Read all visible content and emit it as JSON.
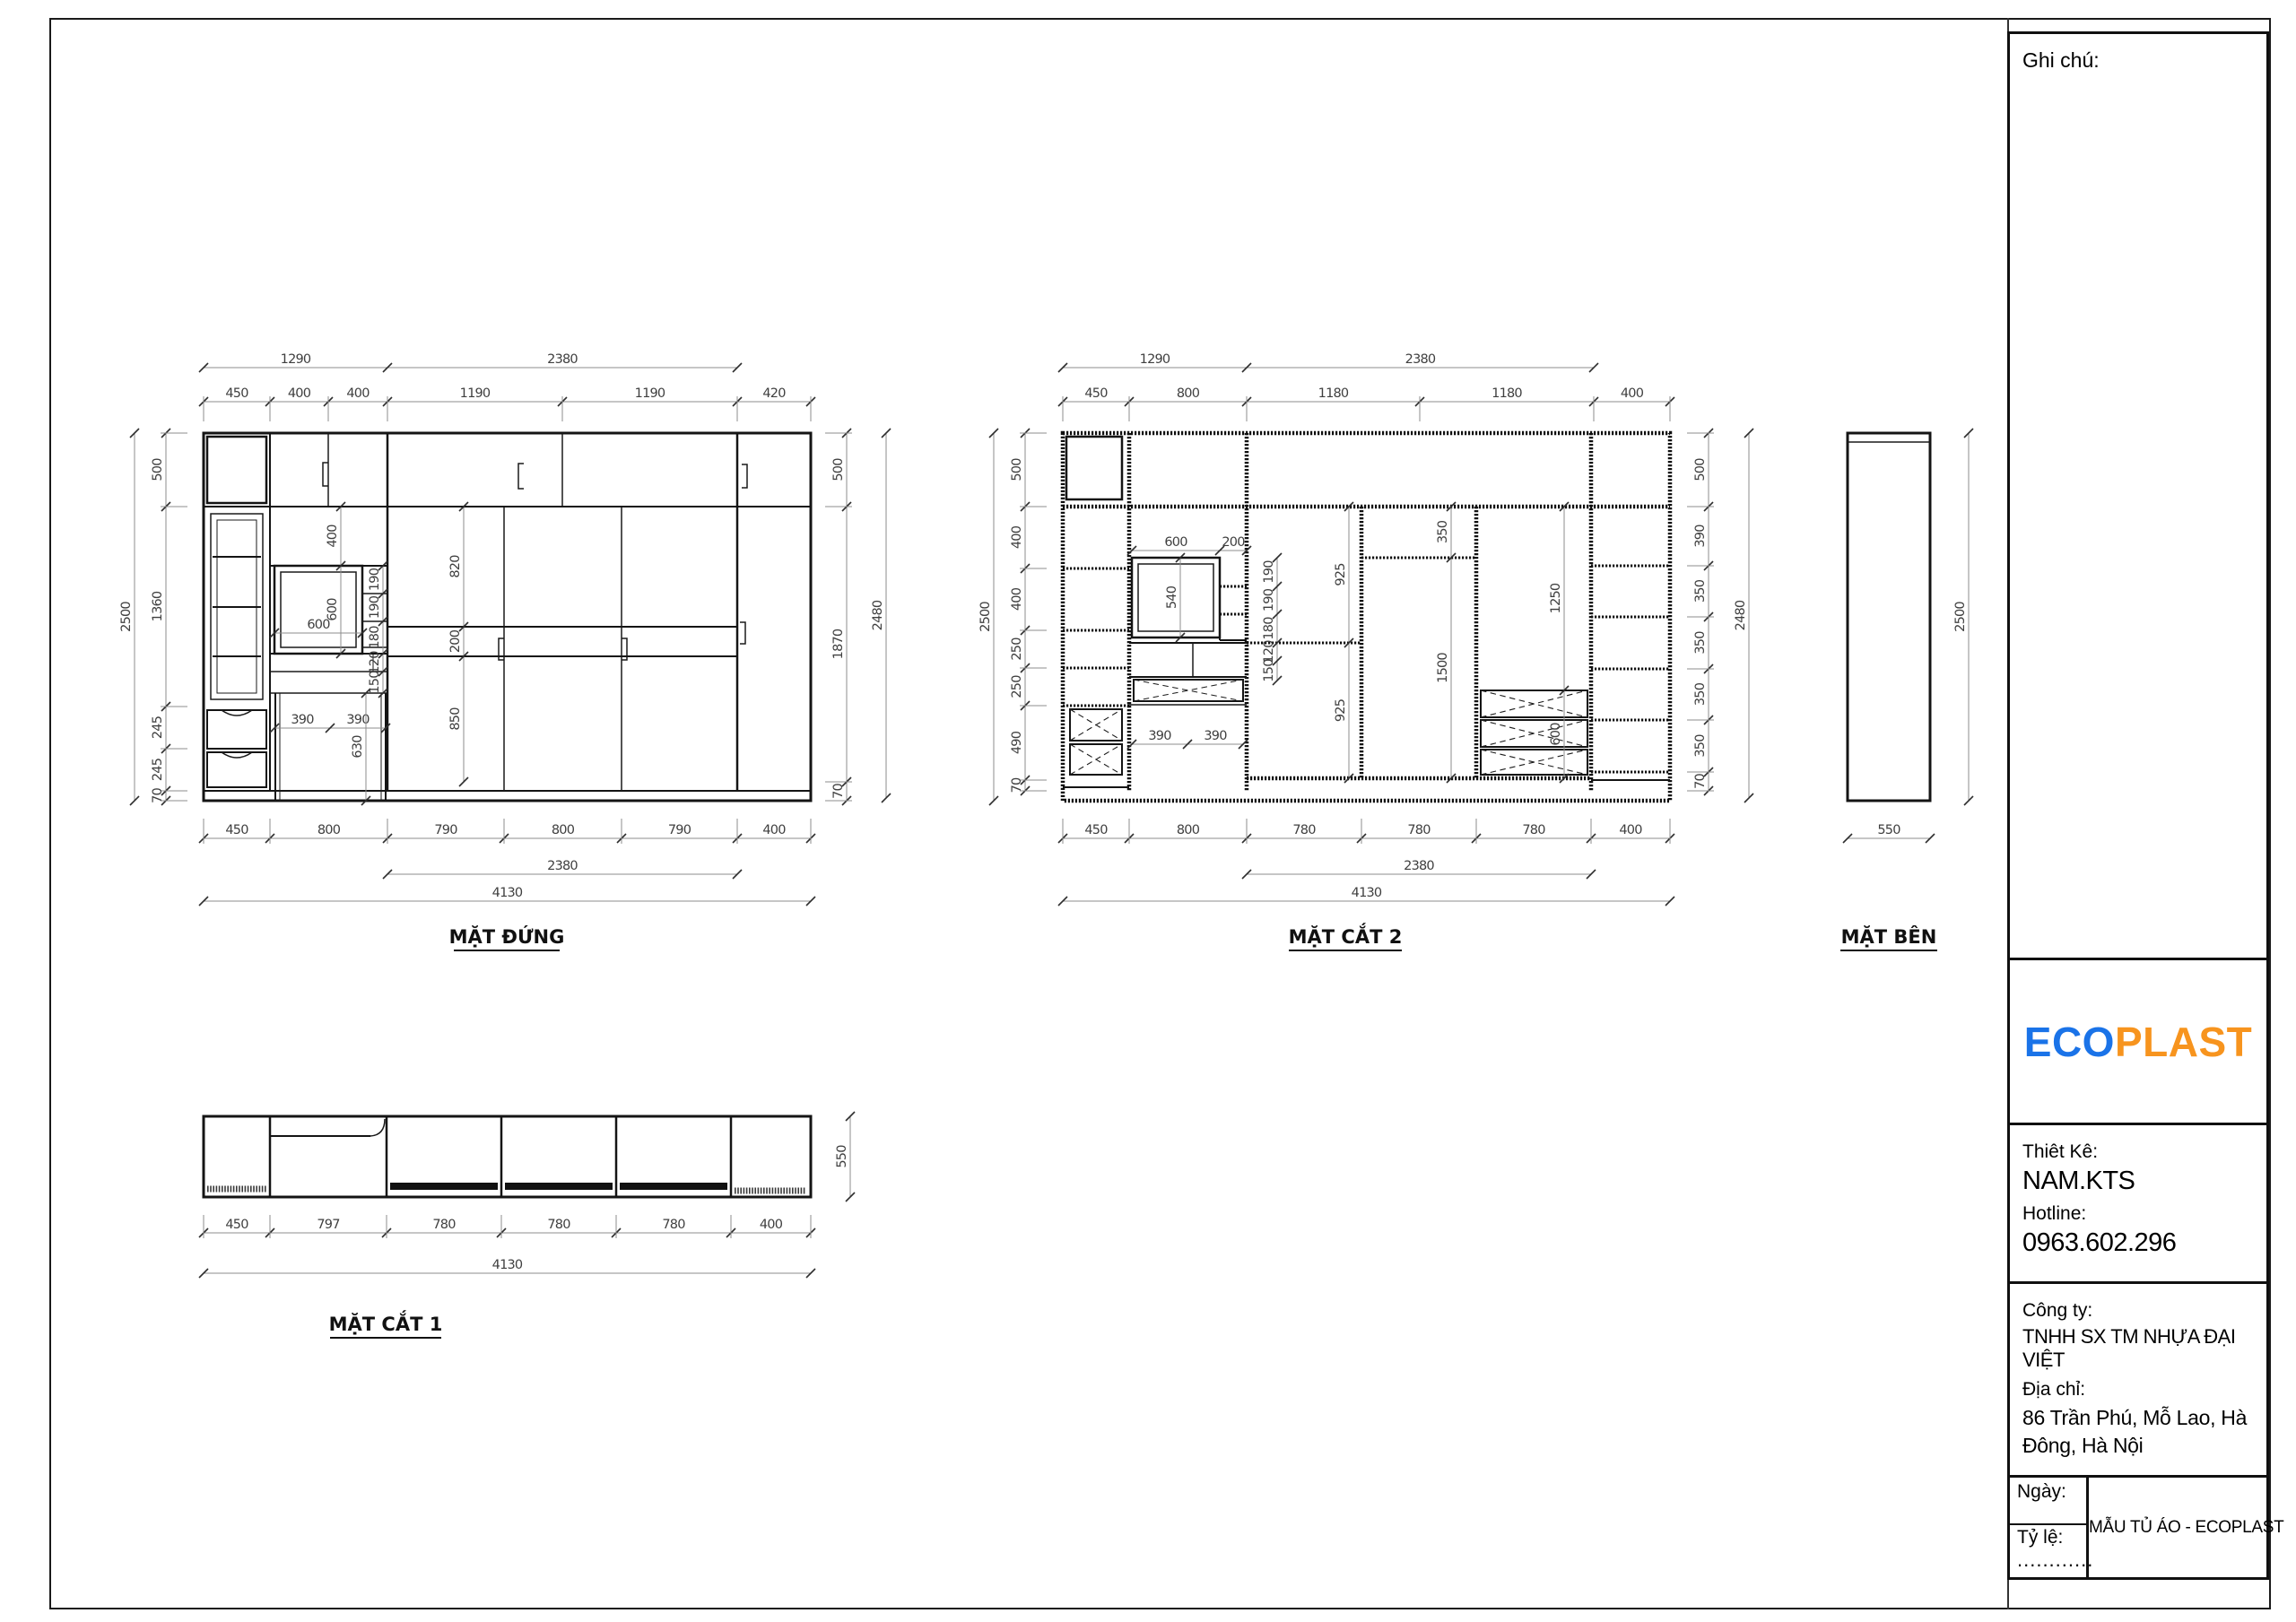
{
  "views": {
    "front": {
      "title": "MẶT ĐỨNG",
      "top_groups": [
        "1290",
        "2380"
      ],
      "top": [
        "450",
        "400",
        "400",
        "1190",
        "1190",
        "420"
      ],
      "left_overall": "2500",
      "left": [
        "500",
        "1360",
        "245",
        "245",
        "70"
      ],
      "right": [
        "500",
        "1870",
        "70"
      ],
      "right_overall": "2480",
      "chain_upper": [
        "400",
        "600"
      ],
      "mirror_w": "600",
      "niche": [
        "190",
        "190",
        "180",
        "120",
        "150"
      ],
      "wardrobe": [
        "820",
        "200",
        "850"
      ],
      "legs": [
        "390",
        "390"
      ],
      "leg_h": "630",
      "bottom": [
        "450",
        "800",
        "790",
        "800",
        "790",
        "400"
      ],
      "bottom_groups": [
        "2380",
        "4130"
      ]
    },
    "section2": {
      "title": "MẶT CẮT 2",
      "top_groups": [
        "1290",
        "2380"
      ],
      "top": [
        "450",
        "800",
        "1180",
        "1180",
        "400"
      ],
      "left_overall": "2500",
      "left": [
        "500",
        "400",
        "400",
        "250",
        "250",
        "490",
        "70"
      ],
      "right": [
        "500",
        "390",
        "350",
        "350",
        "350",
        "350",
        "70"
      ],
      "right_overall": "2480",
      "mirror_top": [
        "600",
        "200"
      ],
      "mirror_h": "540",
      "niche": [
        "190",
        "190",
        "180",
        "120",
        "150"
      ],
      "hang": [
        "925",
        "925"
      ],
      "center": [
        "350",
        "1500"
      ],
      "right_inner": [
        "1250",
        "600"
      ],
      "legs": [
        "390",
        "390"
      ],
      "bottom": [
        "450",
        "800",
        "780",
        "780",
        "780",
        "400"
      ],
      "bottom_groups": [
        "2380",
        "4130"
      ]
    },
    "side": {
      "title": "MẶT BÊN",
      "height": "2500",
      "width": "550"
    },
    "section1": {
      "title": "MẶT CẮT 1",
      "depth": "550",
      "bottom": [
        "450",
        "797",
        "780",
        "780",
        "780",
        "400"
      ],
      "bottom_group": "4130"
    }
  },
  "titleblock": {
    "notes_label": "Ghi chú:",
    "logo": {
      "part1": "ECO",
      "part2": "PLAST",
      "color1": "#1a73e8",
      "color2": "#f7941e"
    },
    "designer_label": "Thiêt Kê:",
    "designer": "NAM.KTS",
    "hotline_label": "Hotline:",
    "hotline": "0963.602.296",
    "company_label": "Công ty:",
    "company": "TNHH SX TM NHỰA ĐẠI VIỆT",
    "address_label": "Địa chỉ:",
    "address": "86 Trần Phú, Mỗ Lao, Hà Đông, Hà Nội",
    "date_label": "Ngày:",
    "scale_label": "Tỷ lệ:",
    "scale_value": "............",
    "project": "MẪU TỦ ÁO - ECOPLAST"
  }
}
